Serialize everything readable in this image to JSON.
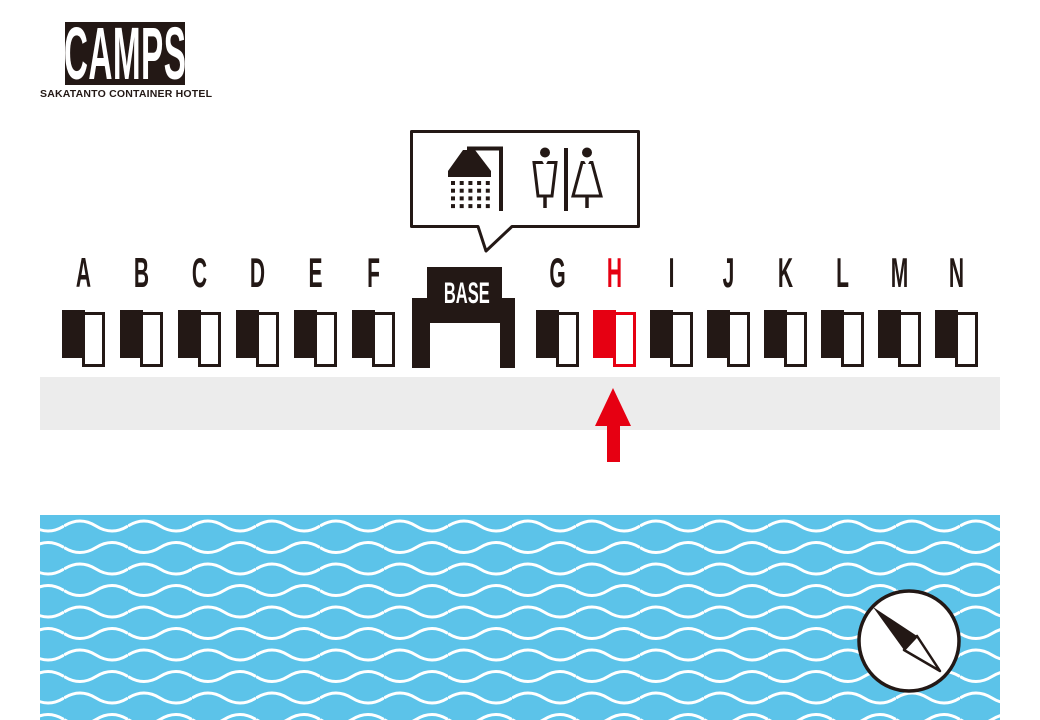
{
  "logo": {
    "title": "CAMPS",
    "subtitle": "SAKATANTO CONTAINER HOTEL"
  },
  "facilities_bubble": {
    "icons": [
      "shower-icon",
      "mens-restroom-icon",
      "womens-restroom-icon"
    ]
  },
  "map": {
    "base_label": "BASE",
    "units_west": [
      "A",
      "B",
      "C",
      "D",
      "E",
      "F"
    ],
    "units_east": [
      "G",
      "H",
      "I",
      "J",
      "K",
      "L",
      "M",
      "N"
    ],
    "highlighted_unit": "H",
    "marker": "red-arrow-up-at-unit-H"
  },
  "compass": "compass-needle-pointing-northwest",
  "colors": {
    "ink": "#231815",
    "highlight_red": "#e60012",
    "water_blue": "#5cc3e9",
    "walkway_gray": "#ececec",
    "background": "#ffffff"
  }
}
